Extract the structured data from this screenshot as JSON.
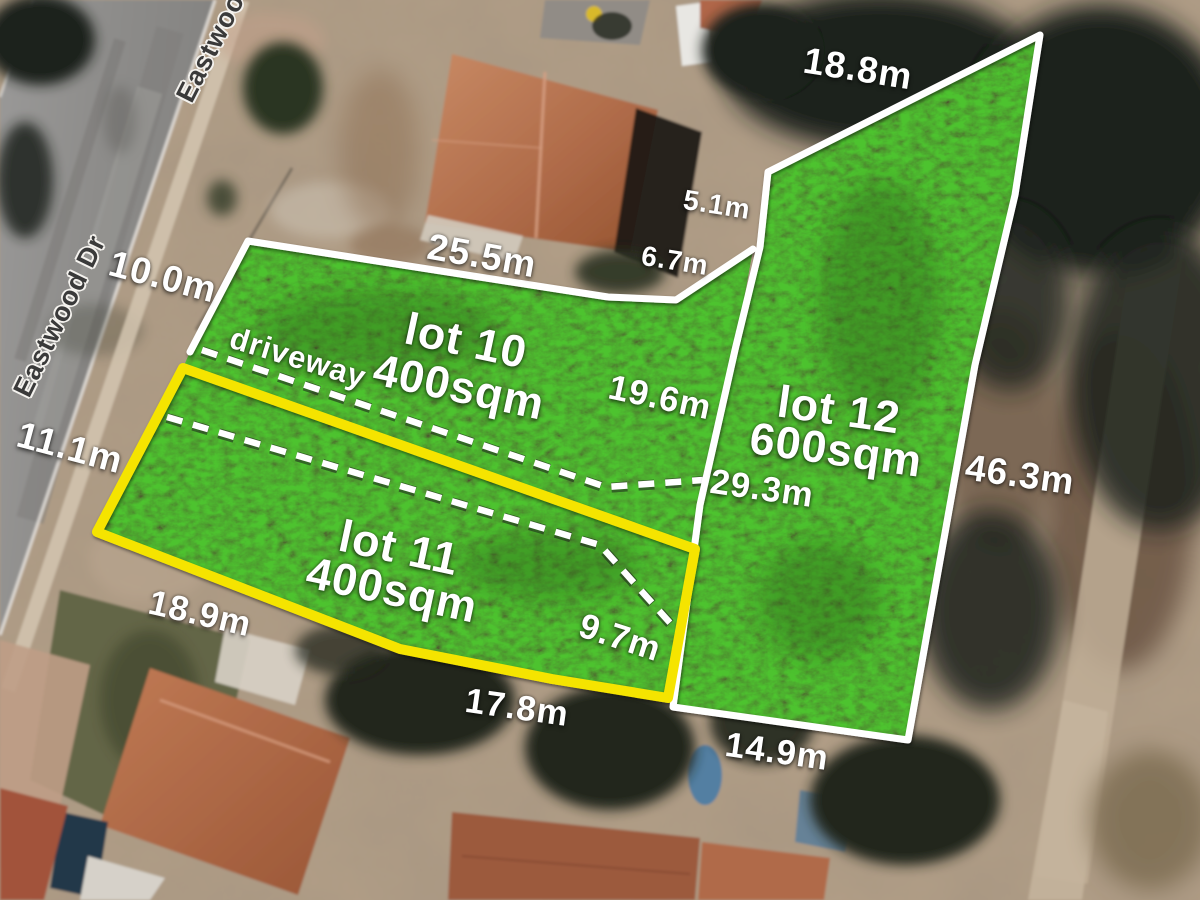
{
  "title": "Aerial land subdivision plan",
  "street": {
    "name": "Eastwood Dr"
  },
  "driveway": {
    "label": "driveway"
  },
  "lots": [
    {
      "name": "lot 10",
      "area": "400sqm",
      "outline": "white"
    },
    {
      "name": "lot 11",
      "area": "400sqm",
      "outline": "yellow"
    },
    {
      "name": "lot 12",
      "area": "600sqm",
      "outline": "white"
    }
  ],
  "measurements": {
    "w10_0": "10.0m",
    "w11_1": "11.1m",
    "w25_5": "25.5m",
    "w5_1": "5.1m",
    "w6_7": "6.7m",
    "w18_8": "18.8m",
    "w19_6": "19.6m",
    "w29_3": "29.3m",
    "w46_3": "46.3m",
    "w18_9": "18.9m",
    "w9_7": "9.7m",
    "w17_8": "17.8m",
    "w14_9": "14.9m"
  },
  "colors": {
    "grass": "#3f7d1e",
    "lot_outline": "#ffffff",
    "lot11_outline": "#f5e400",
    "dash": "#ffffff",
    "label_text": "#ffffff"
  }
}
